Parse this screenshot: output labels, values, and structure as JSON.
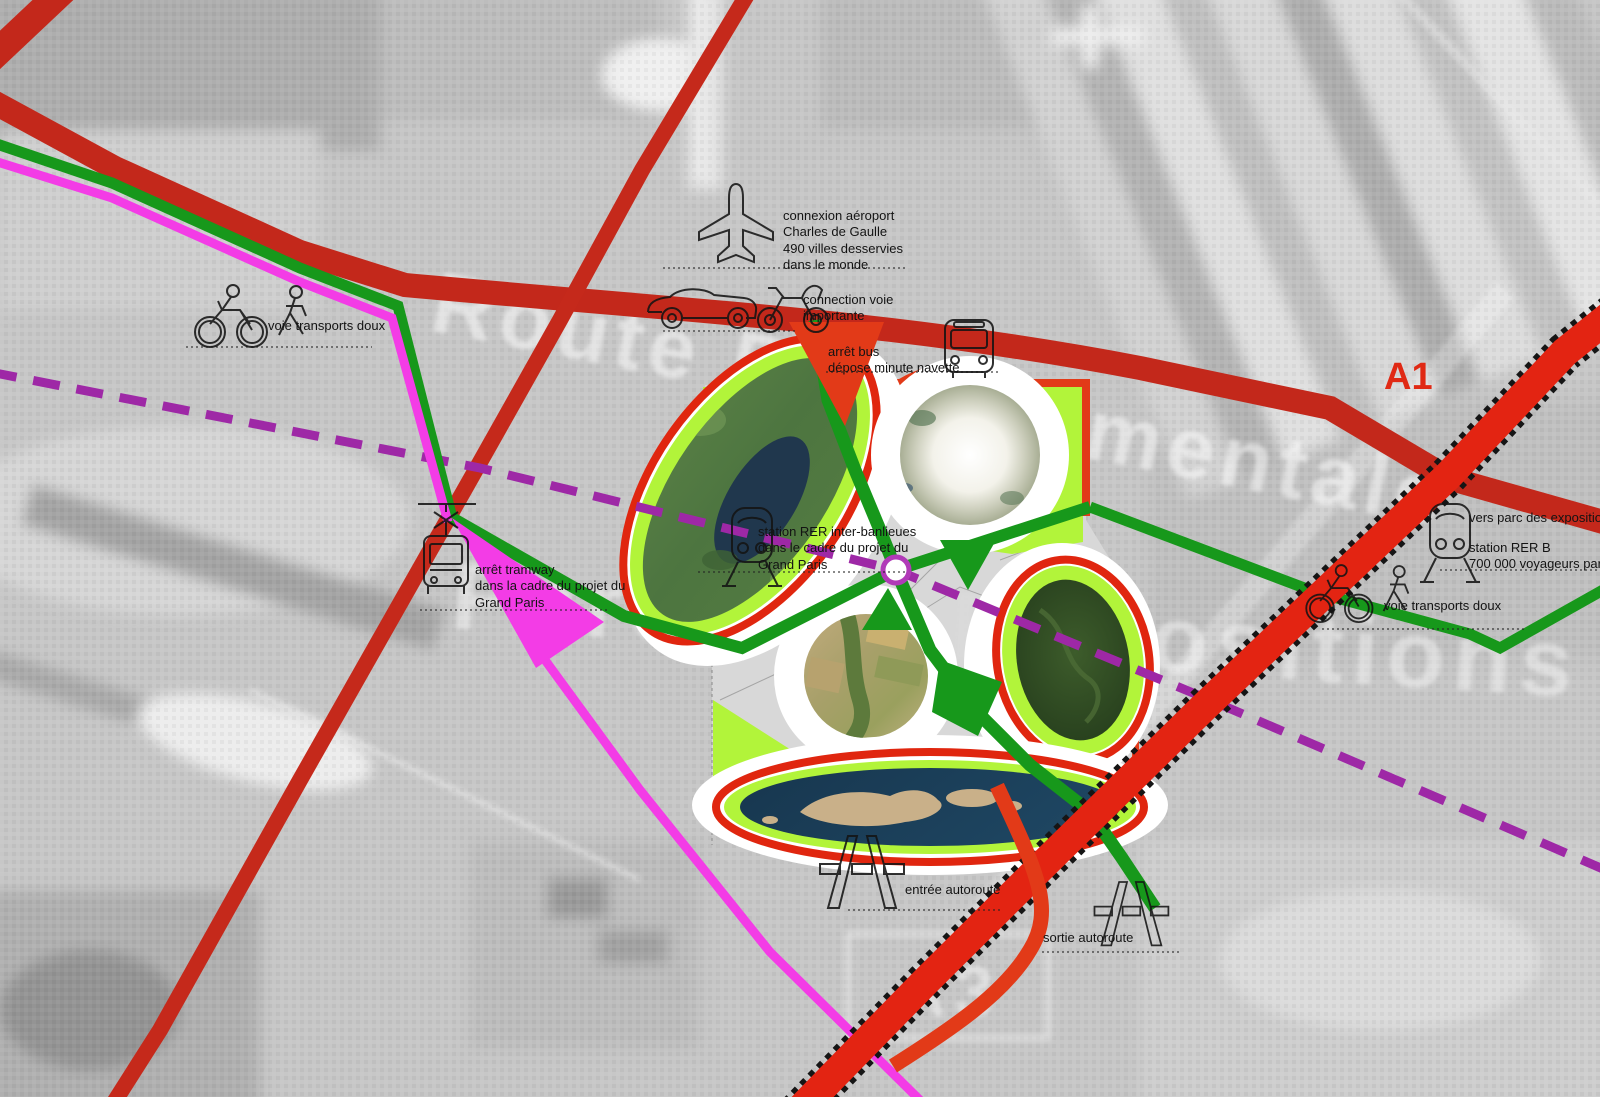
{
  "watermarks": {
    "road": "Route Départementale",
    "park": "Parc des Expositions",
    "motorway_box": "A3"
  },
  "labels": {
    "airport": "connexion aéroport\nCharles de Gaulle\n490 villes desservies\ndans le monde",
    "road_connection": "connection voie\nimportante",
    "bus": "arrêt bus\ndépose minute navette",
    "soft_left": "voie transports doux",
    "tram": "arrêt tramway\ndans la cadre du projet du\nGrand Paris",
    "rer_center": "station RER inter-banlieues\ndans le cadre du projet du\nGrand Paris",
    "to_expo": "vers parc des expositions",
    "rer_b": "station RER B\n700 000 voyageurs par jour",
    "soft_right": "voie transports doux",
    "motorway_in": "entrée autoroute",
    "motorway_out": "sortie autoroute",
    "a1": "A1"
  },
  "icons": {
    "airplane": "airplane-icon",
    "car": "car-icon",
    "quad": "quad-icon",
    "bus": "bus-icon",
    "bicycle_pedestrian_left": "bicycle-pedestrian-icon",
    "bicycle_pedestrian_right": "bicycle-pedestrian-icon",
    "tram": "tram-icon",
    "train_center": "train-icon",
    "train_right": "train-icon",
    "motorway_in": "motorway-icon",
    "motorway_out": "motorway-icon"
  },
  "colors": {
    "route_red": "#c3281b",
    "highway_red": "#e32412",
    "accent_red": "#e23a18",
    "green_path": "#17981b",
    "lime": "#b2f43a",
    "magenta": "#f33ce6",
    "purple": "#9e28a6"
  }
}
